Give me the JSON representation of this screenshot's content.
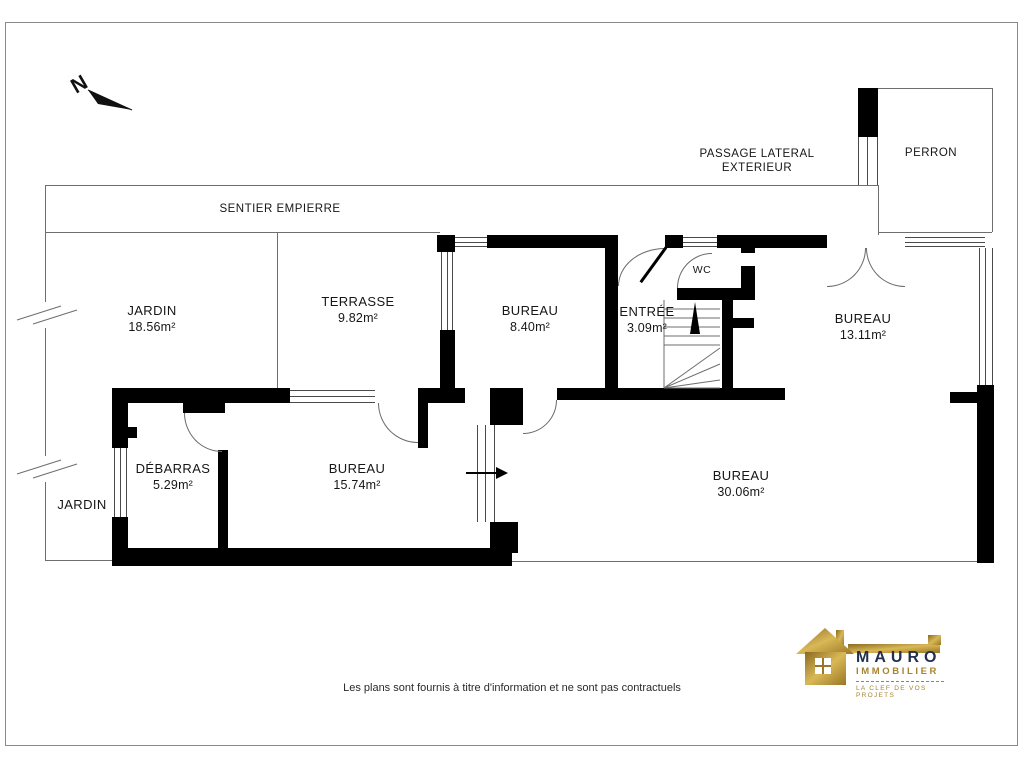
{
  "plan": {
    "north_label": "N",
    "rooms": [
      {
        "name": "JARDIN",
        "area": "18.56m²"
      },
      {
        "name": "TERRASSE",
        "area": "9.82m²"
      },
      {
        "name": "BUREAU",
        "area": "8.40m²"
      },
      {
        "name": "ENTRÉE",
        "area": "3.09m²"
      },
      {
        "name": "WC",
        "area": ""
      },
      {
        "name": "BUREAU",
        "area": "13.11m²"
      },
      {
        "name": "DÉBARRAS",
        "area": "5.29m²"
      },
      {
        "name": "BUREAU",
        "area": "15.74m²"
      },
      {
        "name": "JARDIN",
        "area": ""
      },
      {
        "name": "BUREAU",
        "area": "30.06m²"
      }
    ],
    "site_labels": {
      "sentier": "SENTIER EMPIERRE",
      "passage_line1": "PASSAGE LATERAL",
      "passage_line2": "EXTERIEUR",
      "perron": "PERRON"
    }
  },
  "footer": {
    "disclaimer": "Les plans sont fournis à titre d'information et ne sont pas contractuels"
  },
  "logo": {
    "brand": "MAURO",
    "subtitle": "IMMOBILIER",
    "tagline": "LA CLEF DE VOS PROJETS"
  },
  "colors": {
    "wall": "#000000",
    "thin_line": "#6e6e6e",
    "gold": "#a8842e",
    "navy": "#233050"
  }
}
